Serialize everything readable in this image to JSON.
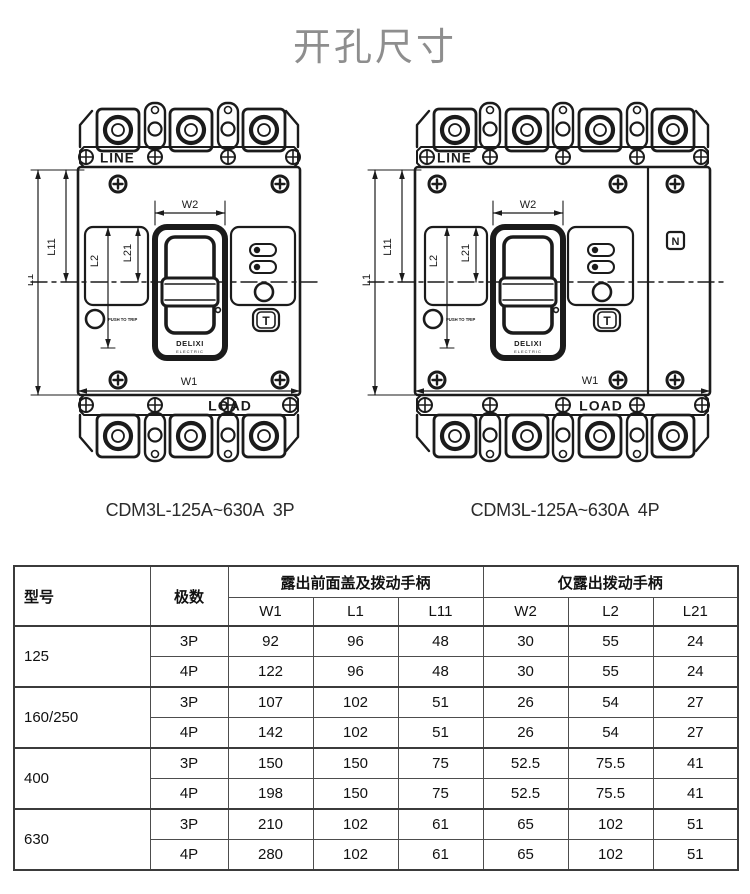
{
  "title": "开孔尺寸",
  "diagrams": {
    "labels": {
      "line": "LINE",
      "load": "LOAD",
      "w1": "W1",
      "w2": "W2",
      "l1": "L1",
      "l11": "L11",
      "l2": "L2",
      "l21": "L21",
      "brand": "DELIXI",
      "brand_sub": "ELECTRIC",
      "push_to_trip": "PUSH TO TRIP",
      "test_button": "T",
      "neutral_mark": "N"
    },
    "left_caption": "CDM3L-125A~630A  3P",
    "right_caption": "CDM3L-125A~630A  4P"
  },
  "table": {
    "headers": {
      "model": "型号",
      "poles": "极数",
      "group1": "露出前面盖及拨动手柄",
      "group2": "仅露出拨动手柄",
      "sub": [
        "W1",
        "L1",
        "L11",
        "W2",
        "L2",
        "L21"
      ]
    },
    "rows": [
      {
        "model": "125",
        "entries": [
          {
            "poles": "3P",
            "values": [
              "92",
              "96",
              "48",
              "30",
              "55",
              "24"
            ]
          },
          {
            "poles": "4P",
            "values": [
              "122",
              "96",
              "48",
              "30",
              "55",
              "24"
            ]
          }
        ]
      },
      {
        "model": "160/250",
        "entries": [
          {
            "poles": "3P",
            "values": [
              "107",
              "102",
              "51",
              "26",
              "54",
              "27"
            ]
          },
          {
            "poles": "4P",
            "values": [
              "142",
              "102",
              "51",
              "26",
              "54",
              "27"
            ]
          }
        ]
      },
      {
        "model": "400",
        "entries": [
          {
            "poles": "3P",
            "values": [
              "150",
              "150",
              "75",
              "52.5",
              "75.5",
              "41"
            ]
          },
          {
            "poles": "4P",
            "values": [
              "198",
              "150",
              "75",
              "52.5",
              "75.5",
              "41"
            ]
          }
        ]
      },
      {
        "model": "630",
        "entries": [
          {
            "poles": "3P",
            "values": [
              "210",
              "102",
              "61",
              "65",
              "102",
              "51"
            ]
          },
          {
            "poles": "4P",
            "values": [
              "280",
              "102",
              "61",
              "65",
              "102",
              "51"
            ]
          }
        ]
      }
    ]
  },
  "colors": {
    "ink": "#1b1b1b",
    "title_gray": "#8e8e8e",
    "table_border": "#3b3b3b"
  }
}
